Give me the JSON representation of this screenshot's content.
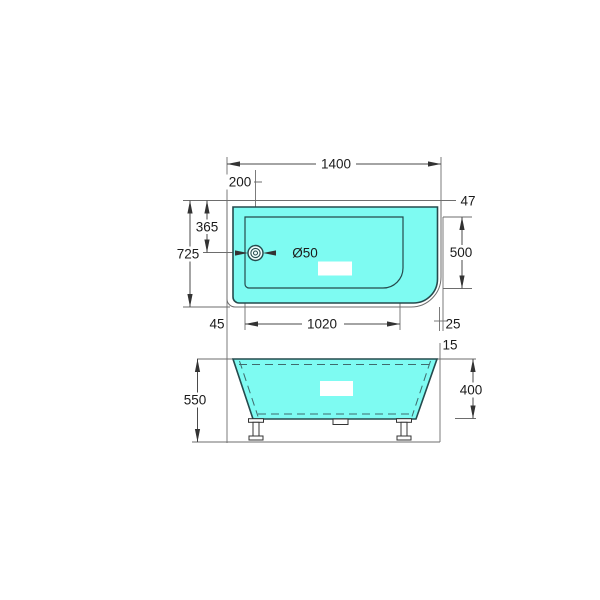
{
  "drawing": {
    "subject": "bathtub-dimension-drawing",
    "colors": {
      "tub_fill": "#7EFBF2",
      "tub_outline": "#254a4d",
      "dimension_lines": "#4a4a4a",
      "text": "#1b1b1b",
      "background": "#ffffff"
    }
  },
  "top_view": {
    "dimensions": {
      "overall_width": "1400",
      "drain_offset_x": "200",
      "rim_gap_top_right": "47",
      "drain_offset_y": "365",
      "overall_depth": "725",
      "basin_depth": "500",
      "drain_diameter": "Ø50",
      "rim_gap_left": "45",
      "basin_length": "1020",
      "rim_gap_right": "25"
    }
  },
  "side_view": {
    "dimensions": {
      "overall_height": "550",
      "body_height": "400",
      "rim_overhang": "15"
    }
  }
}
